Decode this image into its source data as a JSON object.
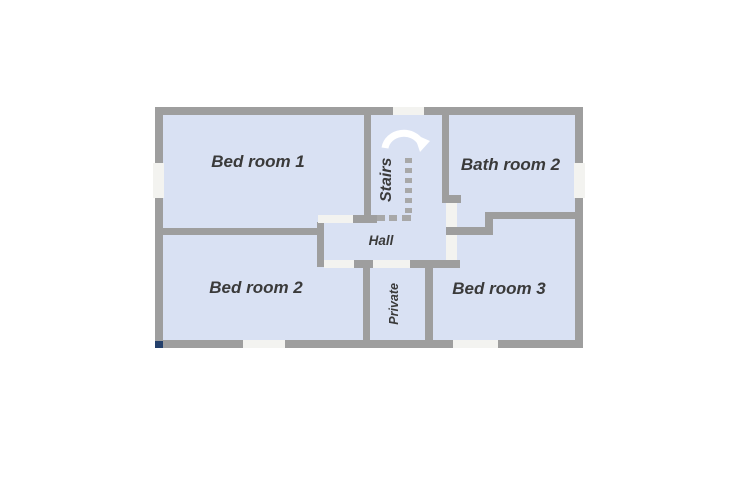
{
  "diagram": {
    "type": "floor-plan",
    "labels": {
      "bedroom1": "Bed room 1",
      "bathroom2": "Bath room 2",
      "bedroom2": "Bed room 2",
      "bedroom3": "Bed room 3",
      "hall": "Hall",
      "stairs": "Stairs",
      "private": "Private"
    },
    "icons": {
      "stairs_direction_arrow": "curved-up-arrow",
      "stairs_treads": "dotted-steps"
    },
    "colors": {
      "room_fill": "#d9e1f3",
      "wall": "#9e9e9e",
      "opening": "#f3f3f0",
      "label_text": "#3a3a3a",
      "arrow": "#ffffff",
      "corner_speck": "#24406b"
    }
  }
}
